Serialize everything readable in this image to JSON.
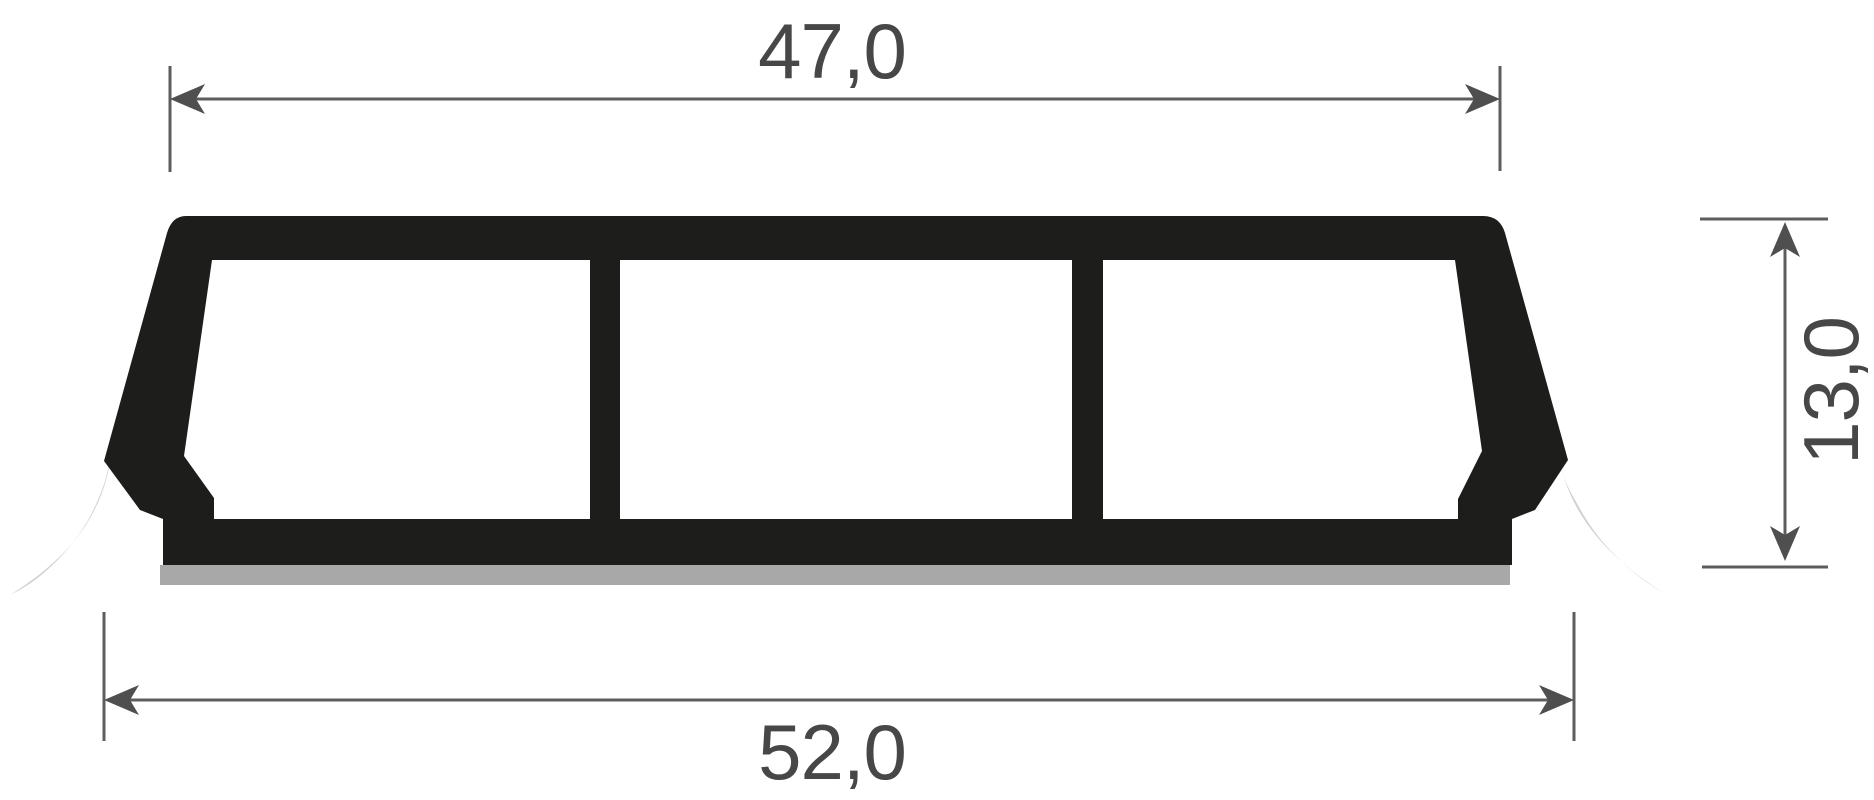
{
  "diagram": {
    "type": "profile-cross-section-technical-drawing",
    "background": "#ffffff",
    "dimensions": {
      "top_width": {
        "label": "47,0",
        "value": 47.0,
        "orientation": "horizontal",
        "position": "top"
      },
      "bottom_width": {
        "label": "52,0",
        "value": 52.0,
        "orientation": "horizontal",
        "position": "bottom"
      },
      "height": {
        "label": "13,0",
        "value": 13.0,
        "orientation": "vertical",
        "position": "right"
      }
    },
    "parts": {
      "body": "rigid profile body with three hollow chambers",
      "left_lip": "soft sealing lip bottom-left",
      "right_lip": "soft sealing lip bottom-right",
      "base_strip": "adhesive strip under base"
    },
    "colors": {
      "profile": "#1d1d1b",
      "soft_lip": "#d2d2d2",
      "base_strip": "#a8a8a8",
      "dimension_line": "#5d5d5d",
      "dimension_arrow": "#4f4f4f",
      "label_text": "#474747"
    }
  }
}
